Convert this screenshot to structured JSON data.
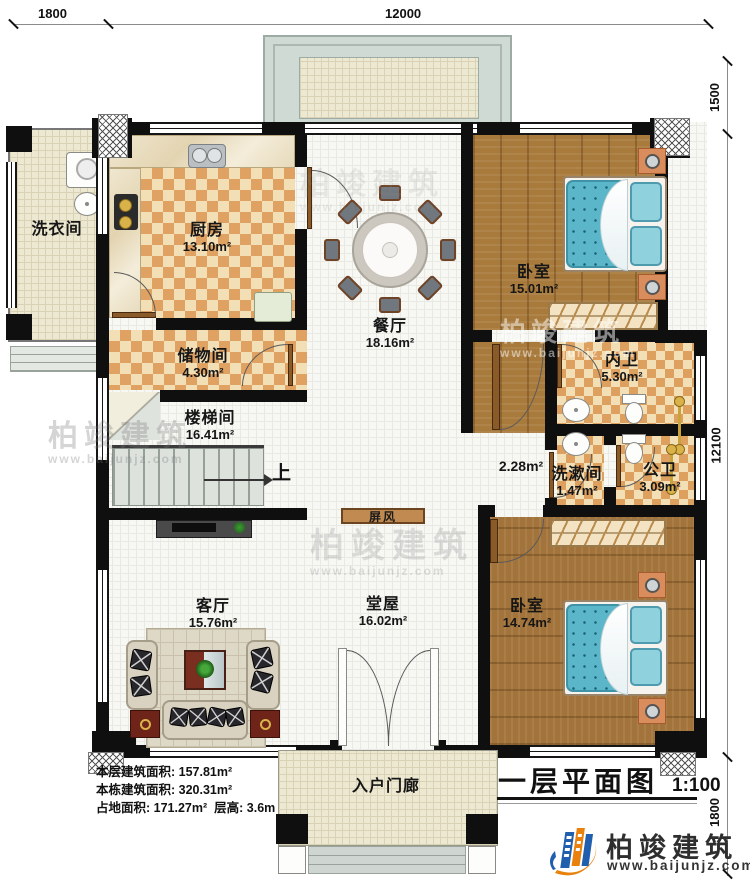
{
  "dimensions": {
    "top_left": "1800",
    "top_main": "12000",
    "right_top": "1500",
    "right_main": "12100",
    "right_bottom": "1800"
  },
  "rooms": {
    "laundry": {
      "name": "洗衣间"
    },
    "kitchen": {
      "name": "厨房",
      "area": "13.10m²"
    },
    "dining": {
      "name": "餐厅",
      "area": "18.16m²"
    },
    "bedroom_top": {
      "name": "卧室",
      "area": "15.01m²"
    },
    "storage": {
      "name": "储物间",
      "area": "4.30m²"
    },
    "stairwell": {
      "name": "楼梯间",
      "area": "16.41m²"
    },
    "inner_bath": {
      "name": "内卫",
      "area": "5.30m²"
    },
    "corridor": {
      "area": "2.28m²"
    },
    "washroom": {
      "name": "洗漱间",
      "area": "1.47m²"
    },
    "public_bath": {
      "name": "公卫",
      "area": "3.09m²"
    },
    "living": {
      "name": "客厅",
      "area": "15.76m²"
    },
    "hall": {
      "name": "堂屋",
      "area": "16.02m²"
    },
    "bedroom_bottom": {
      "name": "卧室",
      "area": "14.74m²"
    },
    "porch": {
      "name": "入户门廊"
    }
  },
  "annotations": {
    "screen": "屏风",
    "up": "上"
  },
  "stats": {
    "floor_area_label": "本层建筑面积:",
    "floor_area": "157.81m²",
    "total_area_label": "本栋建筑面积:",
    "total_area": "320.31m²",
    "footprint_label": "占地面积:",
    "footprint": "171.27m²",
    "height_label": "层高:",
    "height": "3.6m"
  },
  "title_block": {
    "name": "一层平面图",
    "scale": "1:100"
  },
  "brand": {
    "name": "柏竣建筑",
    "website": "www.baijunjz.com"
  },
  "watermark": {
    "text": "柏竣建筑",
    "website": "www.baijunjz.com"
  }
}
